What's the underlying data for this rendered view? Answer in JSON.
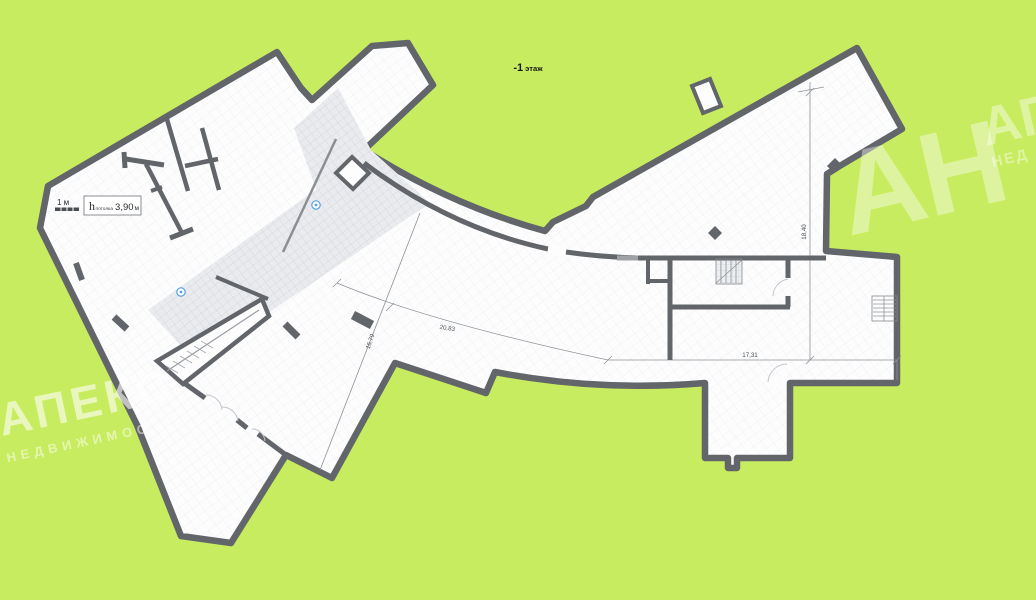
{
  "title": {
    "floor_number": "-1",
    "floor_word": "этаж"
  },
  "legend": {
    "scale_label": "1 м",
    "ceiling": {
      "symbol": "h",
      "subscript": "потолка",
      "value": "3,90",
      "unit": "м",
      "full_text": "h потолка 3,90 м"
    }
  },
  "dimensions": {
    "right_height": "18,40",
    "bottom_width": "17,31",
    "walkway_curve": "20,83",
    "diagonal_width": "16,79"
  },
  "watermarks": {
    "agency_name": "АПЕКС",
    "agency_subtitle": "НЕДВИЖИМОС",
    "initials": "АН",
    "corner_name": "АГ",
    "corner_subtitle": "НЕД"
  },
  "markers": {
    "count": 2,
    "type": "photo-marker"
  },
  "colors": {
    "background": "#c8ec5f",
    "wall": "#626569",
    "floor": "#fdfdfe",
    "hatch": "#e9eaee",
    "dimension_line": "#8f9296",
    "marker_blue": "#57a3e0",
    "watermark": "#ffffff"
  }
}
